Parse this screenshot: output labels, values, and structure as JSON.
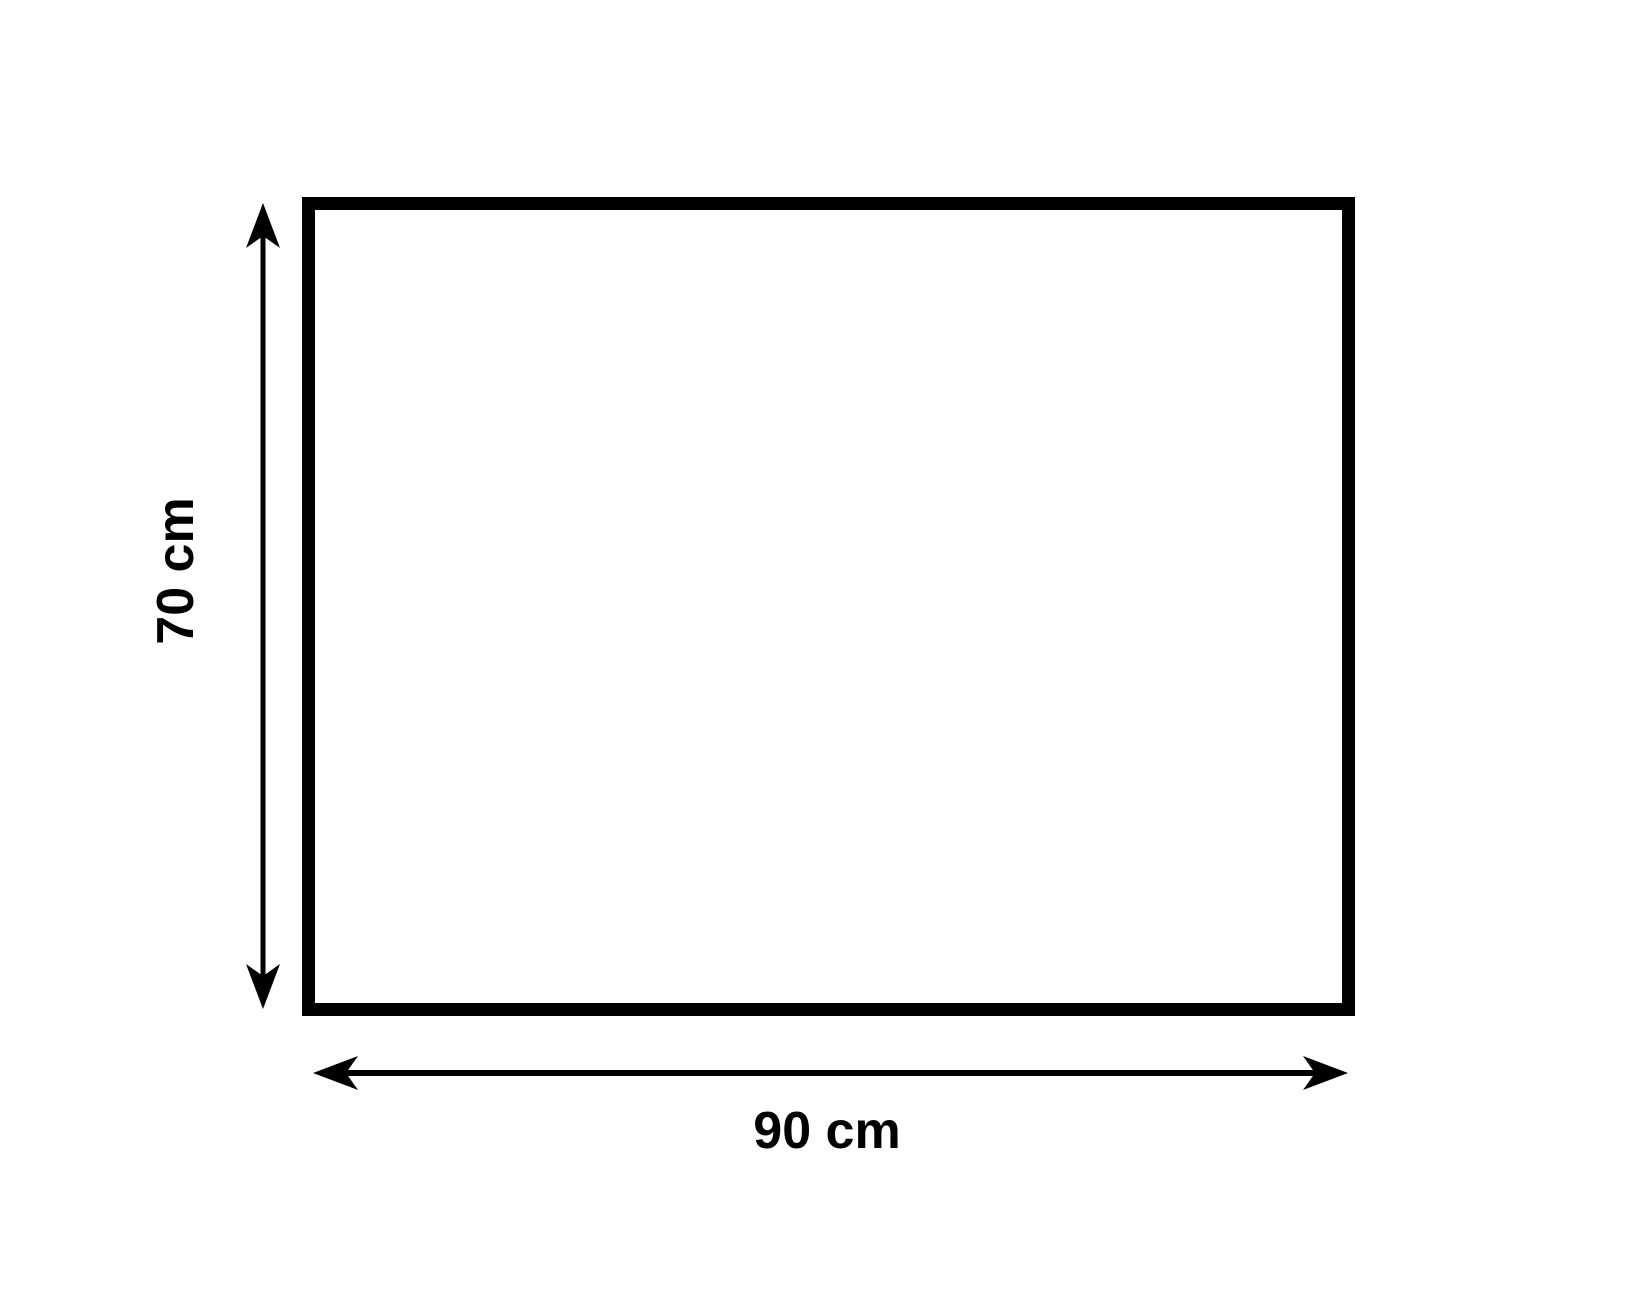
{
  "diagram": {
    "shape": "rectangle",
    "unit": "cm",
    "width_value": 90,
    "height_value": 70,
    "width_label": "90 cm",
    "height_label": "70 cm",
    "colors": {
      "stroke": "#000000",
      "background": "#ffffff"
    }
  }
}
